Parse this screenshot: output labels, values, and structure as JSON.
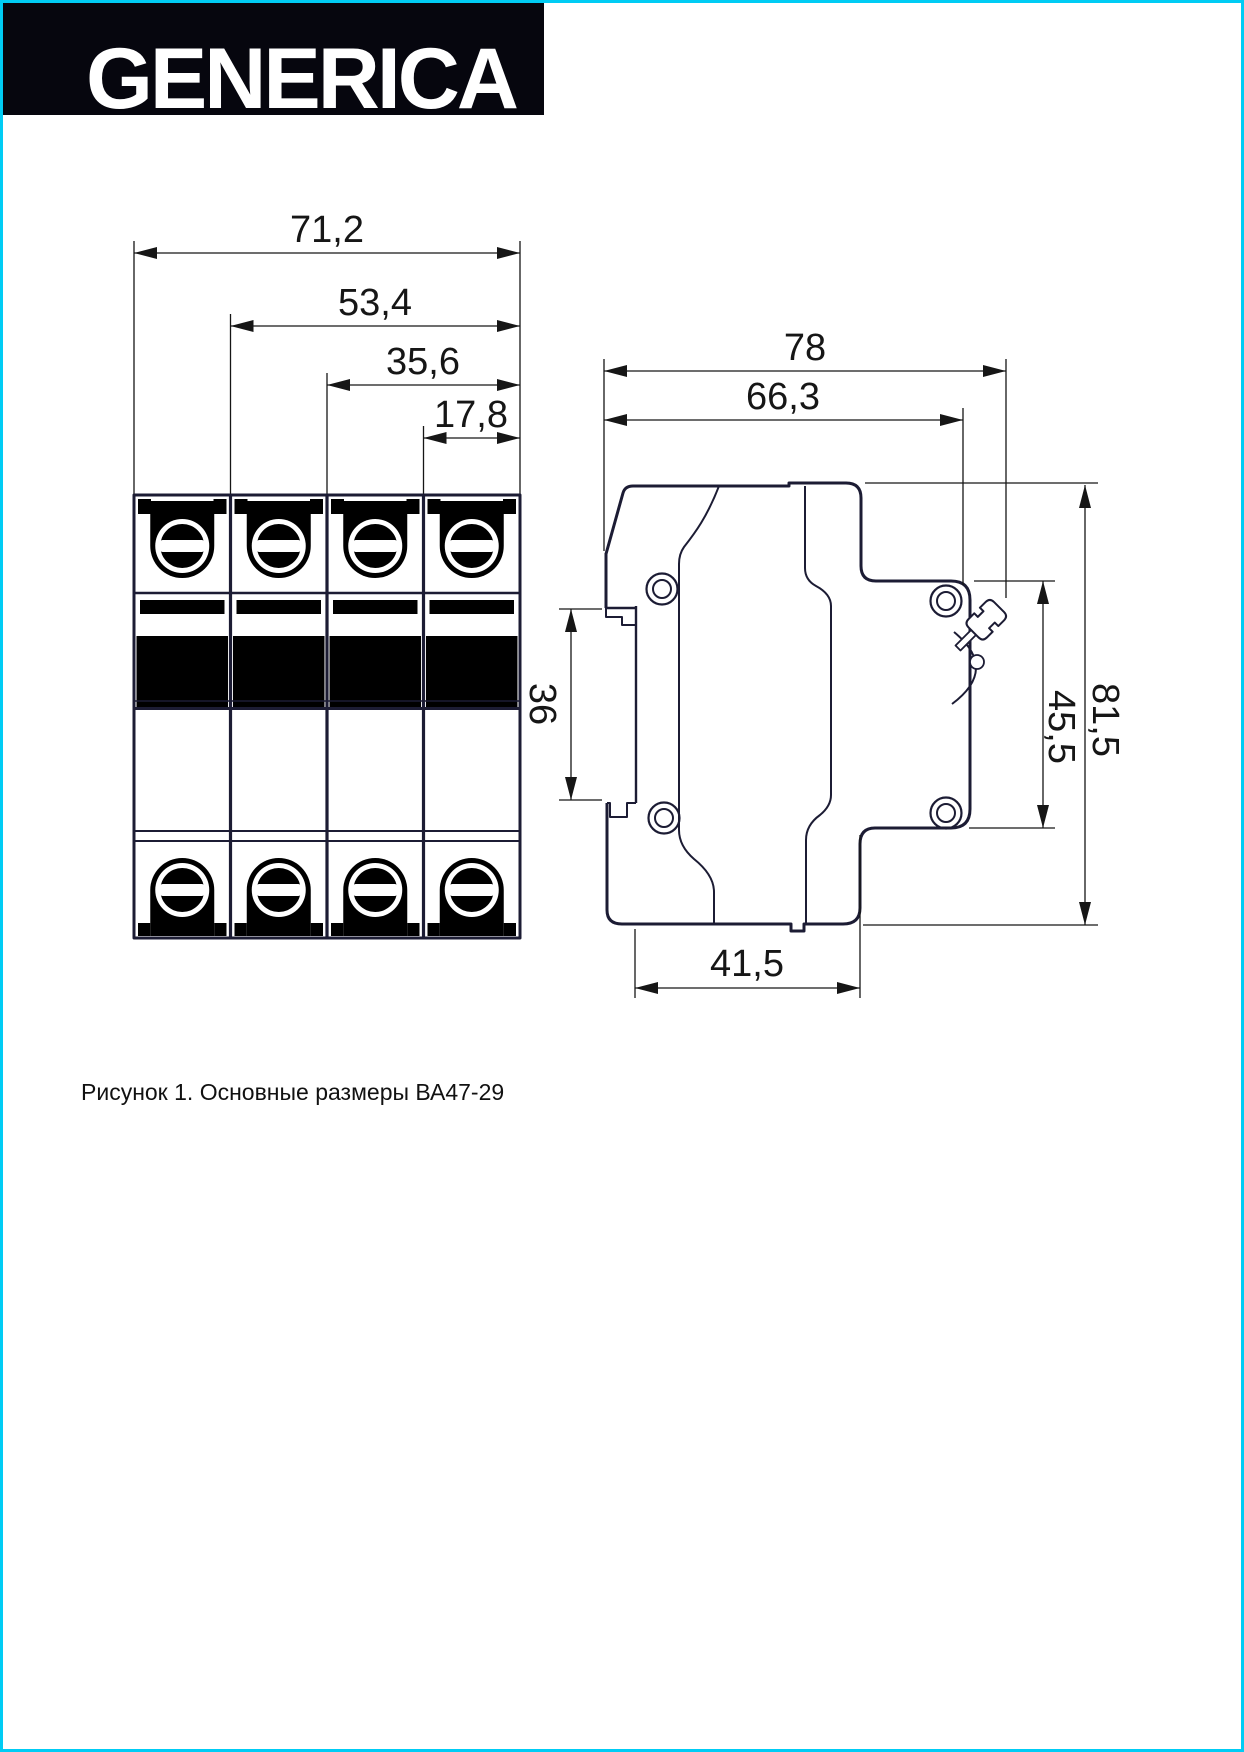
{
  "page": {
    "background": "#ffffff",
    "border_color": "#00ccf4"
  },
  "logo": {
    "text": "GENERICA",
    "bar_color": "#06060e",
    "text_color": "#ffffff"
  },
  "drawing": {
    "line_color": "#1c1c34",
    "dim_color": "#161616",
    "detail_color": "#c3cfd6",
    "dims": {
      "front_total_width": "71,2",
      "front_three_pole_width": "53,4",
      "front_two_pole_width": "35,6",
      "front_one_pole_width": "17,8",
      "side_total_depth": "78",
      "side_body_depth": "66,3",
      "din_rail_height": "36",
      "side_front_height": "45,5",
      "side_total_height": "81,5",
      "side_base_depth": "41,5"
    }
  },
  "caption": "Рисунок 1. Основные размеры ВА47-29"
}
